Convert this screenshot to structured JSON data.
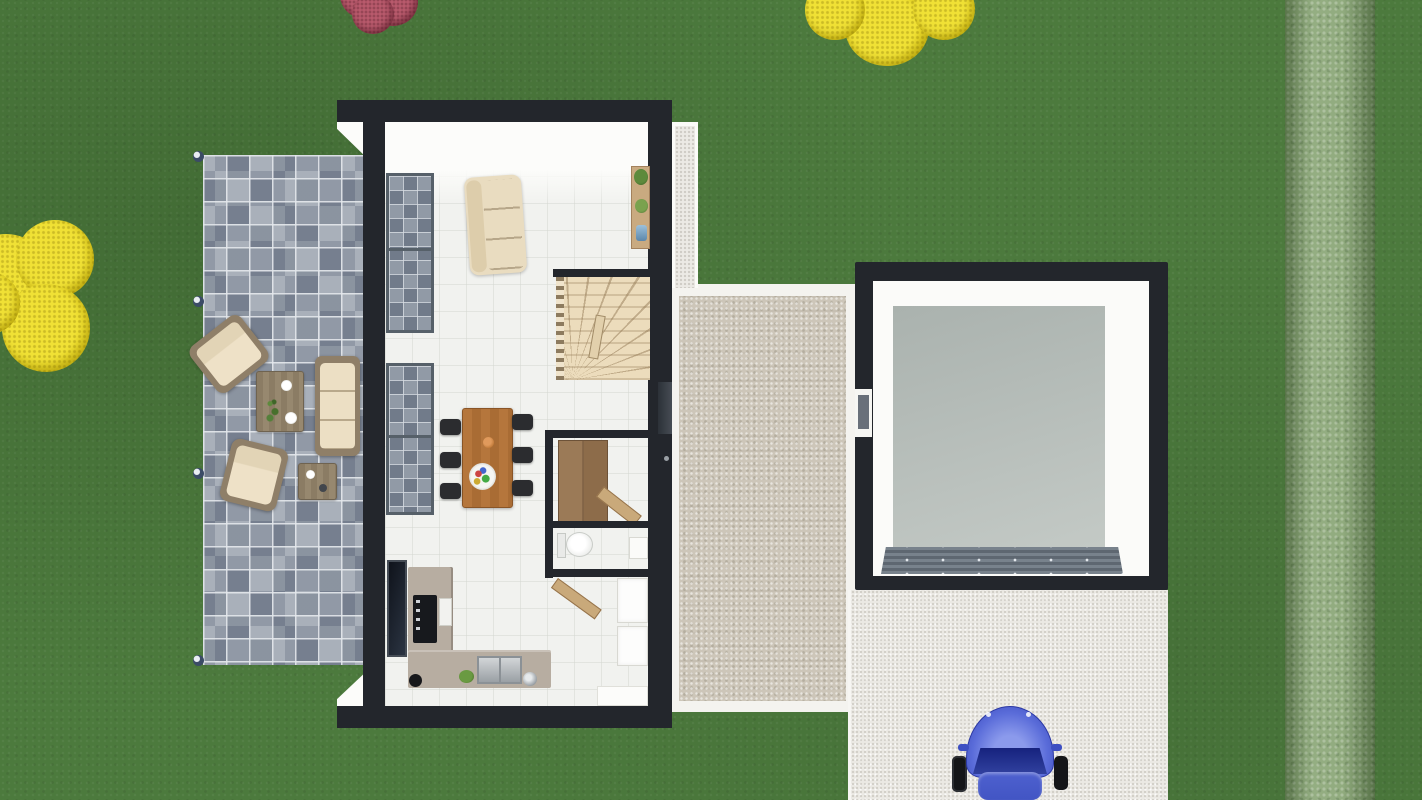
{
  "meta": {
    "title": "House ground floor - 3D top view render"
  },
  "palette": {
    "grass": "#4c7a3d",
    "hedge": "#82a06d",
    "bush_yellow": "#e6d41f",
    "bush_red": "#a6495c",
    "terrace_paver": "#97a0ac",
    "wall_dark": "#23262c",
    "interior_floor": "#f1f2ef",
    "wood_stairs": "#ecdcbc",
    "wood_table": "#b5763c",
    "wood_wardrobe": "#9b7a57",
    "cushion_cream": "#e9dcc0",
    "chair_black": "#2b2c2f",
    "kitchen_counter": "#b7ada1",
    "cobblestone": "#cdc6b9",
    "path_white": "#eceae5",
    "driveway": "#ebe9e4",
    "garage_floor": "#b4bab6",
    "garage_door": "#6e7882",
    "car_blue": "#4c60cf"
  },
  "objects": {
    "lawn": {
      "label": "Lawn"
    },
    "hedge": {
      "label": "Garden hedge"
    },
    "yellow_tree": {
      "label": "Yellow tree"
    },
    "yellow_bush": {
      "label": "Yellow bush"
    },
    "red_bush": {
      "label": "Red flowering bush"
    },
    "terrace": {
      "label": "Stone paved terrace"
    },
    "terrace_light": {
      "label": "Terrace ground light"
    },
    "outdoor_armchair": {
      "label": "Outdoor armchair"
    },
    "outdoor_sofa": {
      "label": "Outdoor sofa"
    },
    "outdoor_coffee_table": {
      "label": "Outdoor coffee table"
    },
    "outdoor_side_table": {
      "label": "Outdoor side table"
    },
    "house": {
      "label": "House ground floor"
    },
    "living_window": {
      "label": "Living room window"
    },
    "kitchen_window": {
      "label": "Kitchen window"
    },
    "living_room_sofa": {
      "label": "Living room sofa"
    },
    "wall_shelf": {
      "label": "Wall shelf with plants"
    },
    "staircase": {
      "label": "Winder staircase"
    },
    "dining_table": {
      "label": "Dining table"
    },
    "dining_chair": {
      "label": "Dining chair"
    },
    "wardrobe": {
      "label": "Wardrobe"
    },
    "wardrobe_door": {
      "label": "Closet door ajar"
    },
    "toilet": {
      "label": "Toilet"
    },
    "wc_cabinet": {
      "label": "WC cabinet"
    },
    "pantry_door": {
      "label": "Utility room door ajar"
    },
    "pantry_cabinet": {
      "label": "Storage cabinet"
    },
    "pantry_counter": {
      "label": "Utility counter"
    },
    "kitchen_counter": {
      "label": "L-shaped kitchen counter"
    },
    "oven": {
      "label": "Oven"
    },
    "oven_panel": {
      "label": "Appliance panel"
    },
    "sink": {
      "label": "Kitchen sink"
    },
    "kitchen_item": {
      "label": "Kitchen accessory"
    },
    "side_door": {
      "label": "Side entrance door"
    },
    "courtyard": {
      "label": "Cobblestone courtyard"
    },
    "side_path": {
      "label": "Side path"
    },
    "garage": {
      "label": "Garage"
    },
    "garage_floor": {
      "label": "Garage floor"
    },
    "garage_door": {
      "label": "Garage sectional door"
    },
    "garage_window": {
      "label": "Garage side window"
    },
    "driveway": {
      "label": "Driveway"
    },
    "car": {
      "label": "Blue car on driveway"
    }
  }
}
